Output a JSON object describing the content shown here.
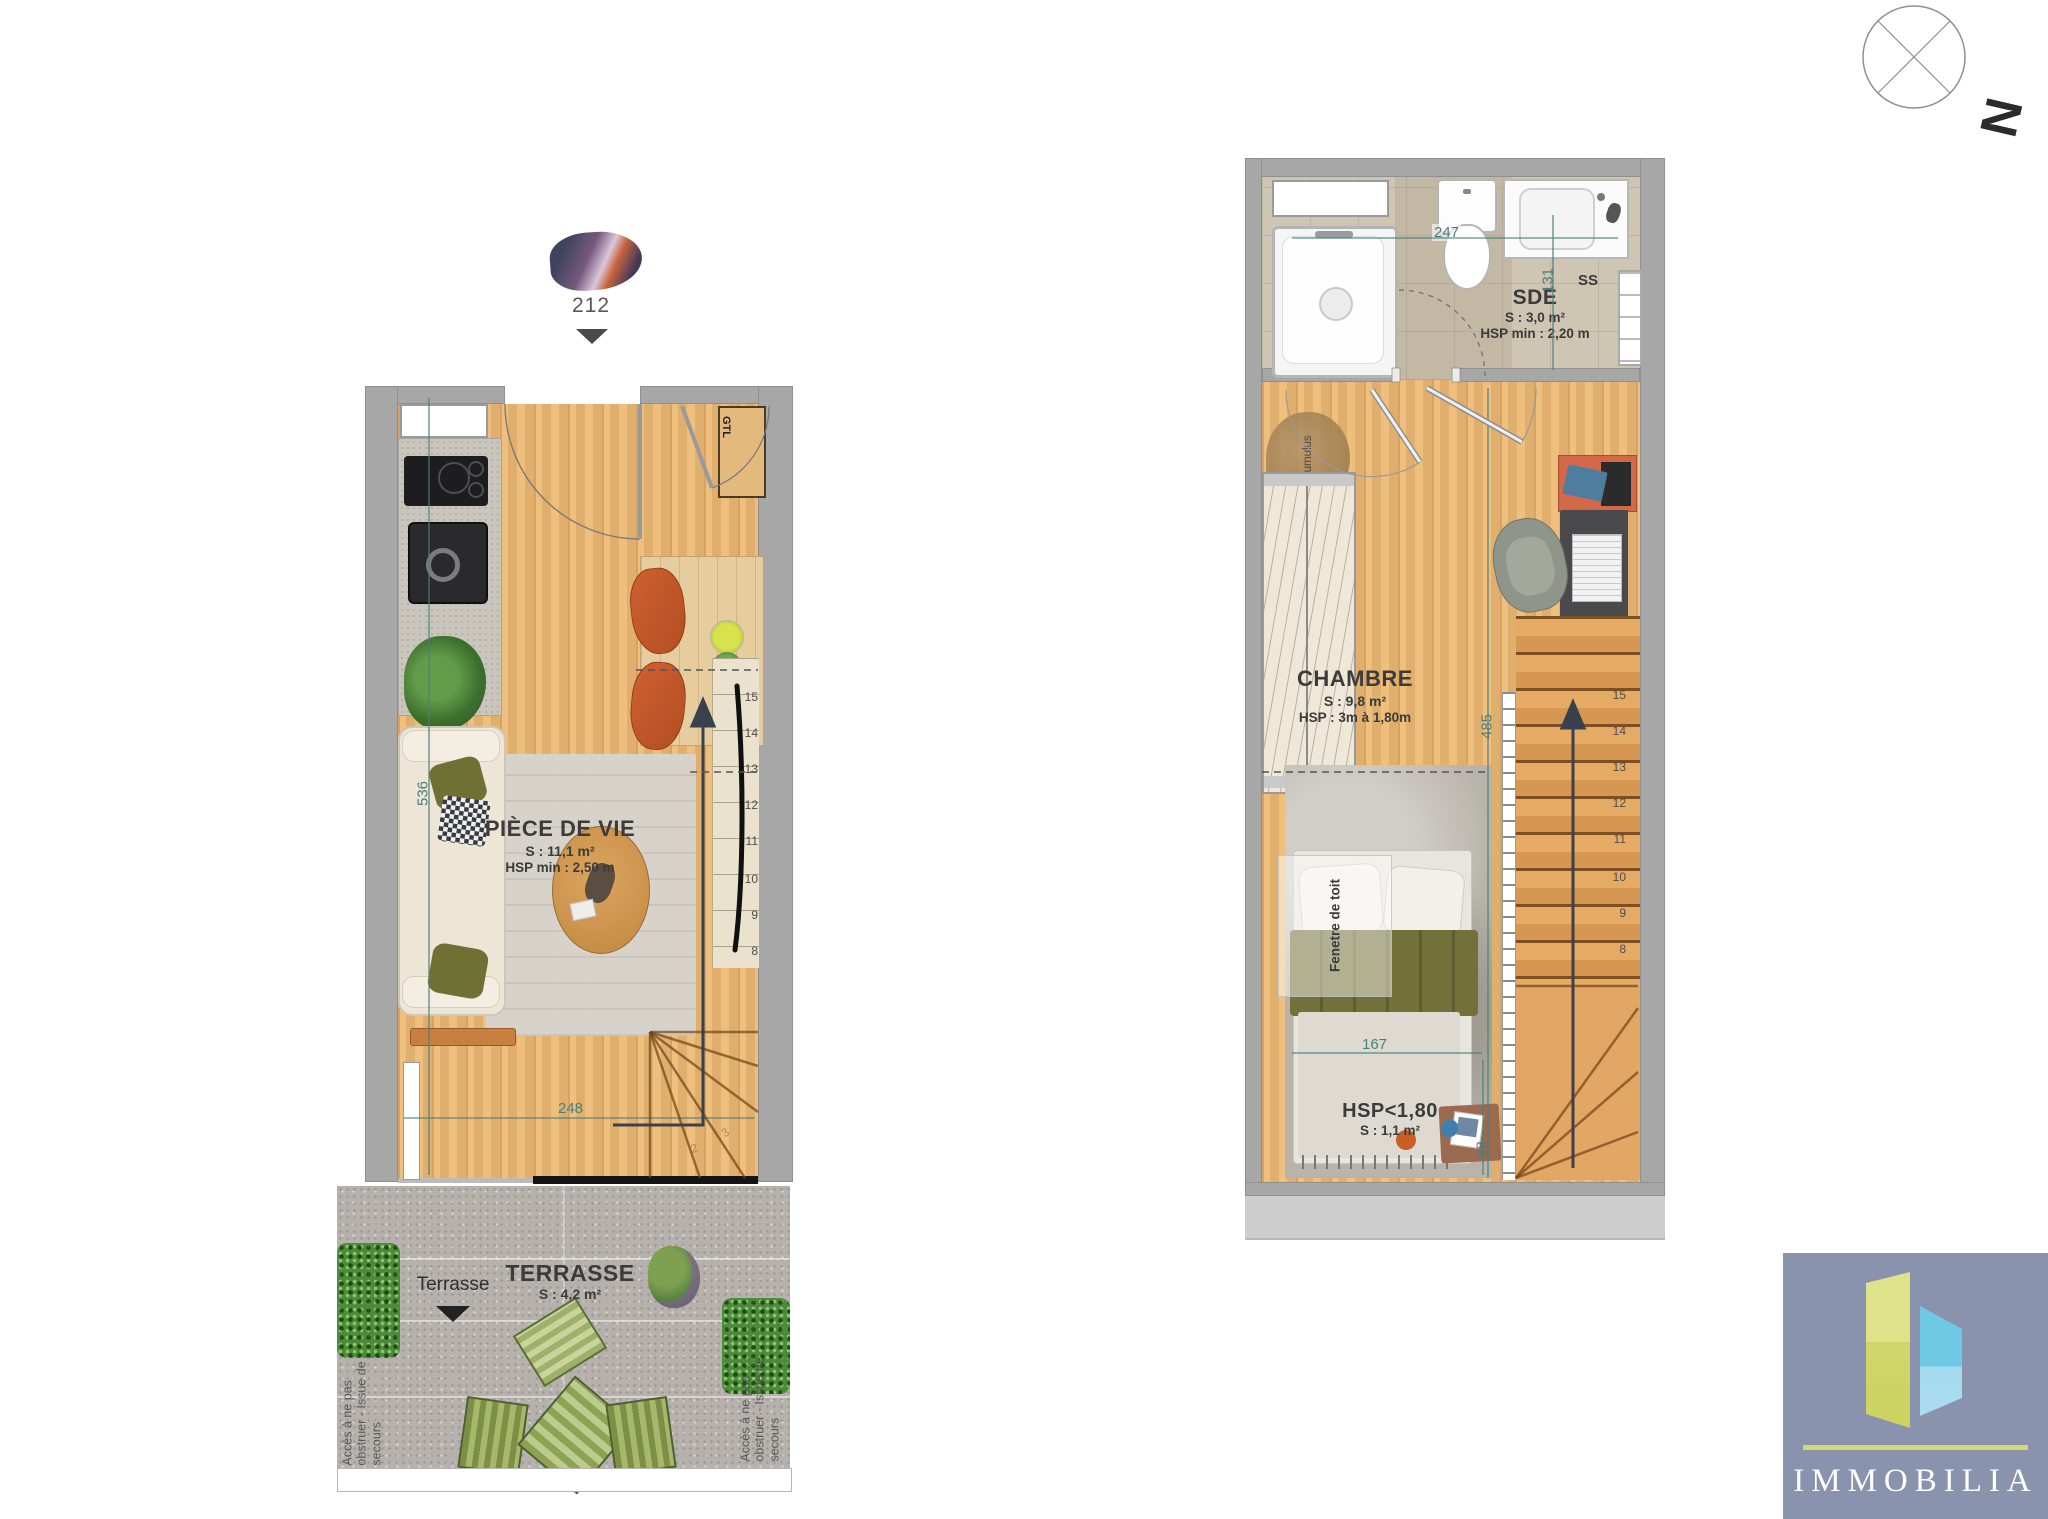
{
  "marker": {
    "number": "212"
  },
  "compass": {
    "label": "N"
  },
  "ground_floor": {
    "title": "PIÈCE DE VIE",
    "area": "S : 11,1 m²",
    "ceiling": "HSP min : 2,50 m",
    "gtl": "GTL",
    "pf": "PF",
    "dim_height": "536",
    "dim_width": "248",
    "stairs": [
      "15",
      "14",
      "13",
      "12",
      "11",
      "10",
      "9",
      "8"
    ],
    "winders": [
      "2",
      "3"
    ]
  },
  "terrace": {
    "pointer_label": "Terrasse",
    "title": "TERRASSE",
    "area": "S : 4,2 m²",
    "access_note": "Accès à ne pas obstruer - Issue de secours"
  },
  "upper_floor": {
    "bathroom": {
      "title": "SDE",
      "area": "S : 3,0 m²",
      "ceiling": "HSP min : 2,20 m",
      "towel_rail": "SS",
      "dim_width": "247",
      "dim_height": "131"
    },
    "bedroom": {
      "title": "CHAMBRE",
      "area": "S : 9,8 m²",
      "ceiling": "HSP : 3m à 1,80m",
      "dim_height": "485",
      "water_heater": "Cumulus",
      "roof_window": "Fenetre de toit"
    },
    "low_ceiling": {
      "title": "HSP<1,80",
      "area": "S : 1,1 m²",
      "dim_width": "167",
      "dim_height": "68"
    },
    "stairs": [
      "15",
      "14",
      "13",
      "12",
      "11",
      "10",
      "9",
      "8"
    ]
  },
  "logo": {
    "name": "IMMOBILIA"
  },
  "colors": {
    "dimension": "#4a7f7c",
    "wall": "#a7a7a7",
    "wood": "#eab671",
    "terrace_gravel": "#b6b1ac",
    "logo_background": "#8a93ae",
    "logo_green": "#d6dc73",
    "logo_blue": "#7ecde6"
  }
}
